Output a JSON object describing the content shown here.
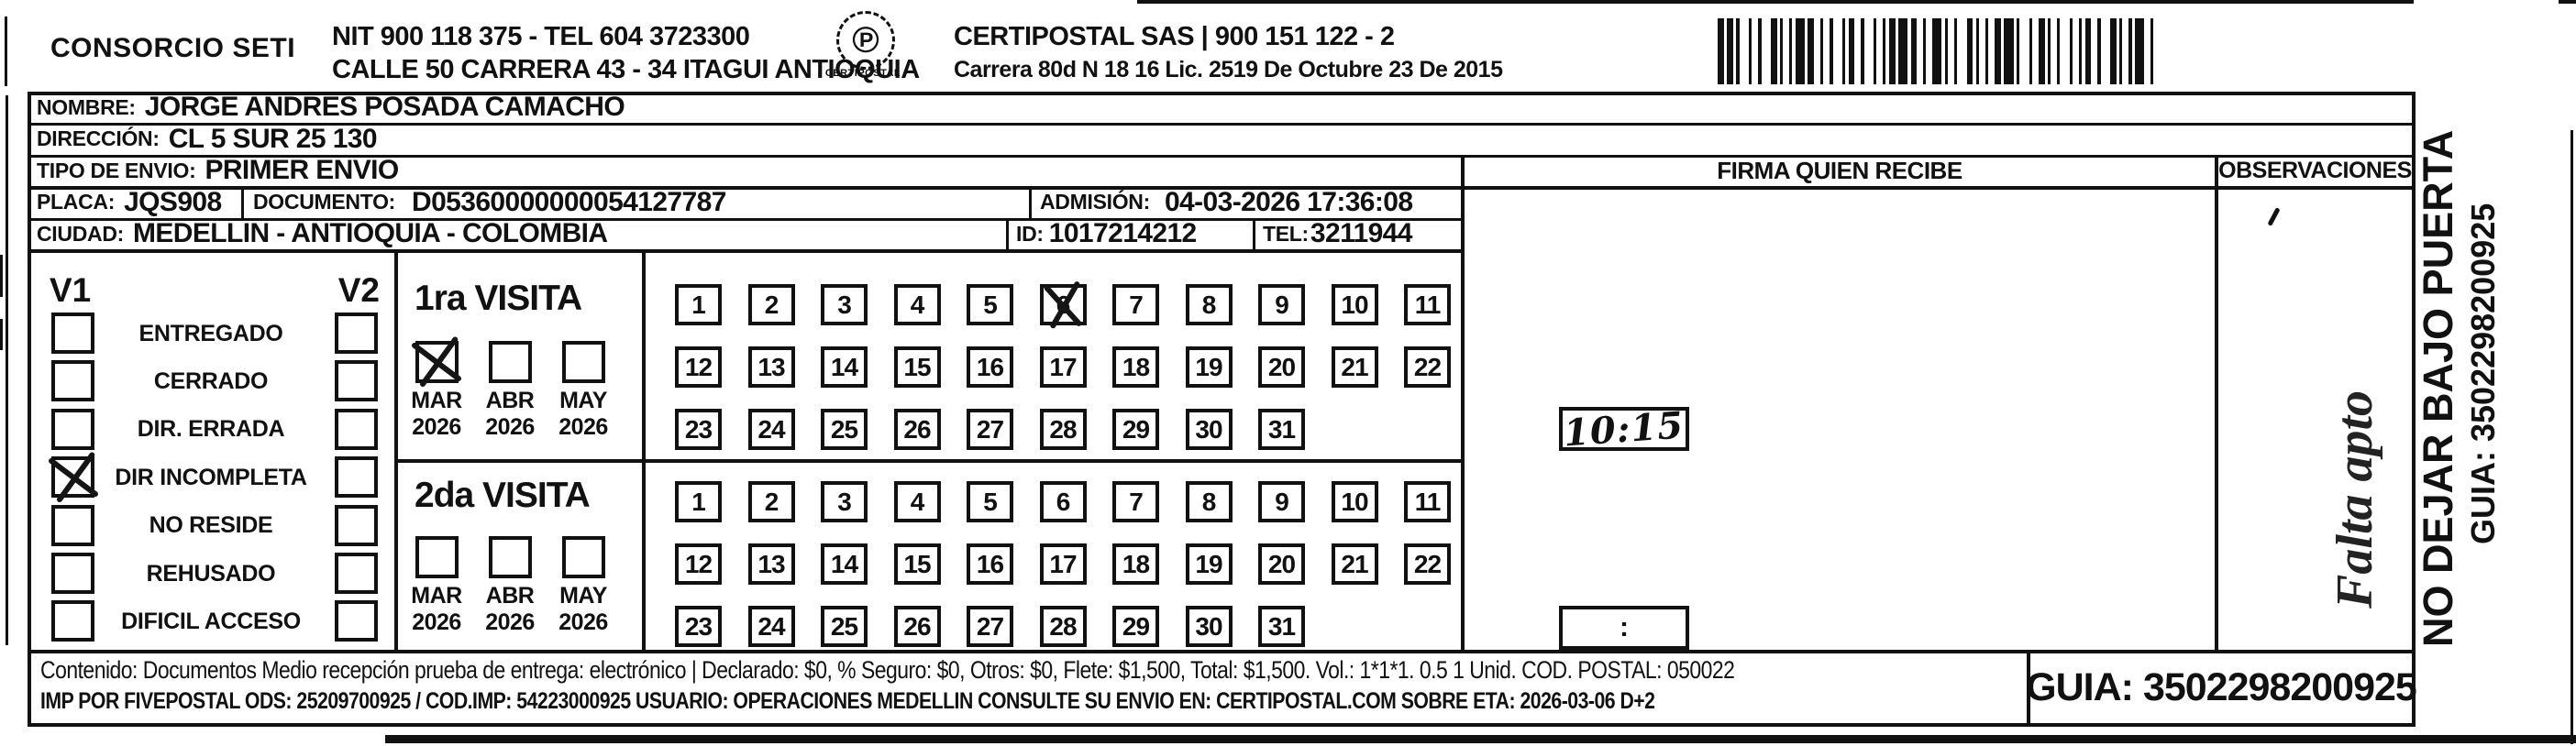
{
  "page": {
    "bg": "#ffffff",
    "ink": "#111111"
  },
  "header": {
    "company": "CONSORCIO SETI",
    "nit_line": "NIT 900 118 375 - TEL 604 3723300",
    "address_line": "CALLE 50 CARRERA 43 - 34 ITAGUI ANTIOQUIA",
    "logo_glyph": "℗",
    "logo_text": "CERTIPOSTAL",
    "operator_line": "CERTIPOSTAL SAS | 900 151 122 - 2",
    "license_line": "Carrera 80d N 18 16  Lic. 2519 De Octubre 23 De 2015",
    "barcode_pattern": "21211312132112113122121311221312112131221231121321121221311312211213121122132112113212"
  },
  "recipient": {
    "nombre_label": "NOMBRE:",
    "nombre": "JORGE ANDRES POSADA CAMACHO",
    "direccion_label": "DIRECCIÓN:",
    "direccion": "CL 5 SUR 25 130",
    "tipo_envio_label": "TIPO DE ENVIO:",
    "tipo_envio": "PRIMER ENVIO",
    "placa_label": "PLACA:",
    "placa": "JQS908",
    "documento_label": "DOCUMENTO:",
    "documento": "D05360000000054127787",
    "admision_label": "ADMISIÓN:",
    "admision": "04-03-2026 17:36:08",
    "ciudad_label": "CIUDAD:",
    "ciudad": "MEDELLIN - ANTIOQUIA - COLOMBIA",
    "id_label": "ID:",
    "id_value": "1017214212",
    "tel_label": "TEL:",
    "tel": "3211944"
  },
  "status_panel": {
    "v1": "V1",
    "v2": "V2",
    "rows": [
      {
        "label": "ENTREGADO"
      },
      {
        "label": "CERRADO"
      },
      {
        "label": "DIR. ERRADA"
      },
      {
        "label": "DIR INCOMPLETA",
        "v1x": true
      },
      {
        "label": "NO RESIDE"
      },
      {
        "label": "REHUSADO"
      },
      {
        "label": "DIFICIL ACCESO"
      }
    ]
  },
  "visits": [
    {
      "title": "1ra VISITA",
      "months": [
        {
          "m": "MAR",
          "y": "2026",
          "x": true
        },
        {
          "m": "ABR",
          "y": "2026"
        },
        {
          "m": "MAY",
          "y": "2026"
        }
      ],
      "days": [
        {
          "n": 1
        },
        {
          "n": 2
        },
        {
          "n": 3
        },
        {
          "n": 4
        },
        {
          "n": 5
        },
        {
          "n": 6,
          "x": true
        },
        {
          "n": 7
        },
        {
          "n": 8
        },
        {
          "n": 9
        },
        {
          "n": 10
        },
        {
          "n": 11
        },
        {
          "n": 12
        },
        {
          "n": 13
        },
        {
          "n": 14
        },
        {
          "n": 15
        },
        {
          "n": 16
        },
        {
          "n": 17
        },
        {
          "n": 18
        },
        {
          "n": 19
        },
        {
          "n": 20
        },
        {
          "n": 21
        },
        {
          "n": 22
        },
        {
          "n": 23
        },
        {
          "n": 24
        },
        {
          "n": 25
        },
        {
          "n": 26
        },
        {
          "n": 27
        },
        {
          "n": 28
        },
        {
          "n": 29
        },
        {
          "n": 30
        },
        {
          "n": 31
        }
      ],
      "time": "10:15",
      "hand": true
    },
    {
      "title": "2da VISITA",
      "months": [
        {
          "m": "MAR",
          "y": "2026"
        },
        {
          "m": "ABR",
          "y": "2026"
        },
        {
          "m": "MAY",
          "y": "2026"
        }
      ],
      "days": [
        {
          "n": 1
        },
        {
          "n": 2
        },
        {
          "n": 3
        },
        {
          "n": 4
        },
        {
          "n": 5
        },
        {
          "n": 6
        },
        {
          "n": 7
        },
        {
          "n": 8
        },
        {
          "n": 9
        },
        {
          "n": 10
        },
        {
          "n": 11
        },
        {
          "n": 12
        },
        {
          "n": 13
        },
        {
          "n": 14
        },
        {
          "n": 15
        },
        {
          "n": 16
        },
        {
          "n": 17
        },
        {
          "n": 18
        },
        {
          "n": 19
        },
        {
          "n": 20
        },
        {
          "n": 21
        },
        {
          "n": 22
        },
        {
          "n": 23
        },
        {
          "n": 24
        },
        {
          "n": 25
        },
        {
          "n": 26
        },
        {
          "n": 27
        },
        {
          "n": 28
        },
        {
          "n": 29
        },
        {
          "n": 30
        },
        {
          "n": 31
        }
      ],
      "time": ":",
      "hand": false
    }
  ],
  "firma": {
    "header": "FIRMA QUIEN RECIBE"
  },
  "observaciones": {
    "header": "OBSERVACIONES",
    "note": "Falta apto"
  },
  "side_note": {
    "line1": "NO DEJAR BAJO PUERTA",
    "line2": "GUIA: 3502298200925"
  },
  "footer": {
    "line1": "Contenido: Documentos Medio recepción prueba de entrega: electrónico | Declarado: $0, % Seguro: $0, Otros: $0, Flete: $1,500, Total: $1,500. Vol.: 1*1*1. 0.5 1 Unid. COD. POSTAL: 050022",
    "line2": "IMP POR FIVEPOSTAL ODS: 25209700925 / COD.IMP: 54223000925 USUARIO: OPERACIONES MEDELLIN CONSULTE SU ENVIO EN: CERTIPOSTAL.COM SOBRE ETA: 2026-03-06 D+2",
    "guia": "GUIA: 3502298200925"
  }
}
